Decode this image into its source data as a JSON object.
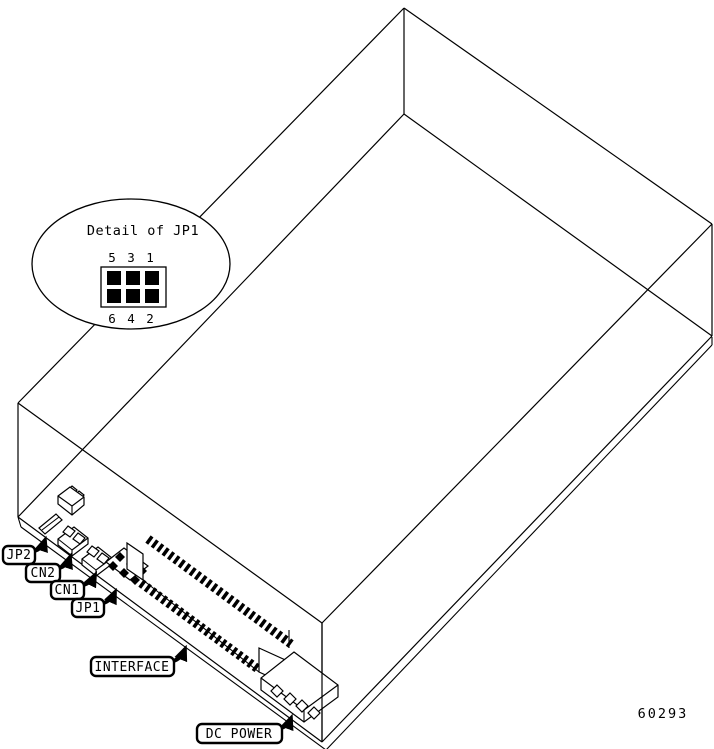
{
  "figure": {
    "number": "60293"
  },
  "detail_callout": {
    "title": "Detail of JP1",
    "pins_top": [
      "5",
      "3",
      "1"
    ],
    "pins_bottom": [
      "6",
      "4",
      "2"
    ]
  },
  "labels": {
    "jp2": "JP2",
    "cn2": "CN2",
    "cn1": "CN1",
    "jp1": "JP1",
    "interface": "INTERFACE",
    "dc_power": "DC POWER"
  },
  "colors": {
    "line": "#000000",
    "background": "#ffffff"
  }
}
